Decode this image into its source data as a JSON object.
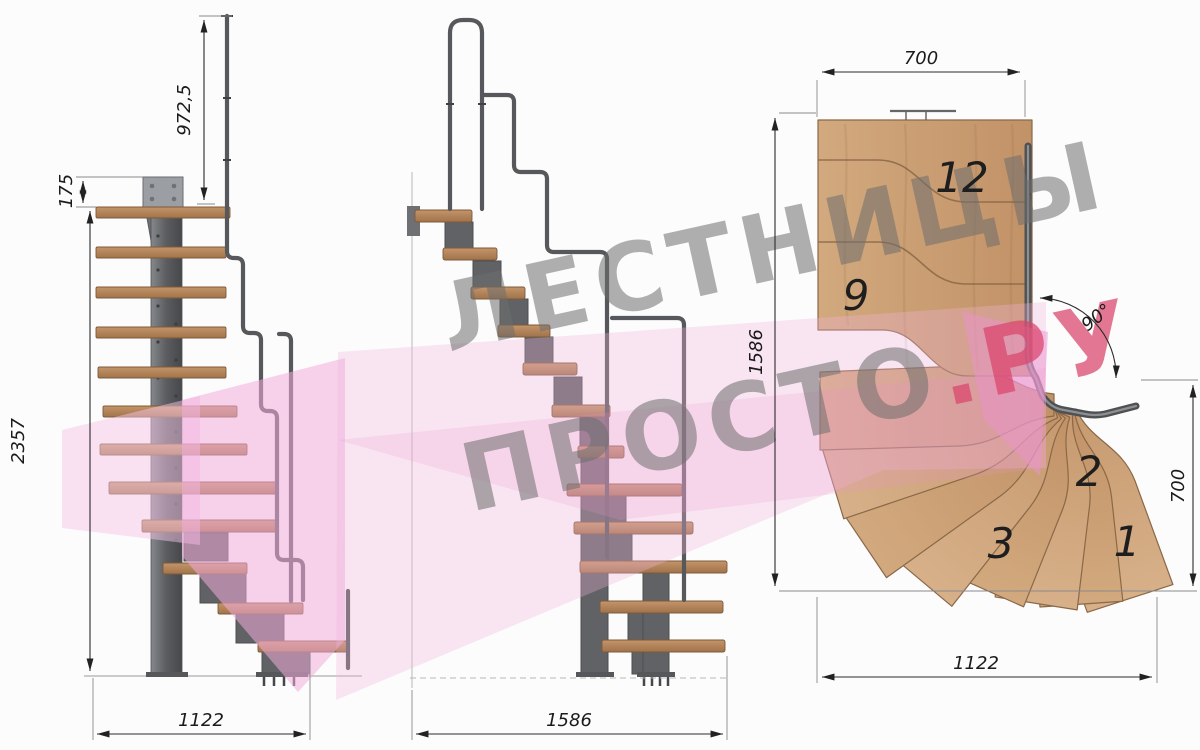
{
  "watermark": {
    "line1": "ЛЕСТНИЦЫ",
    "line2_gray": "ПРОСТО",
    "line2_pink": ".РУ"
  },
  "views": {
    "front": {
      "dims": {
        "handrail_height": "972,5",
        "bracket_offset": "175",
        "total_height": "2357",
        "width": "1122"
      }
    },
    "side": {
      "dims": {
        "depth": "1586"
      }
    },
    "plan": {
      "dims": {
        "top_width": "700",
        "left_depth": "1586",
        "right_depth": "700",
        "bottom_width": "1122",
        "turn_angle": "90°"
      },
      "steps": {
        "s12": "12",
        "s9": "9",
        "s3": "3",
        "s2": "2",
        "s1": "1"
      }
    }
  },
  "colors": {
    "background": "#fcfcfc",
    "wood_front": "#b98a5e",
    "wood_plan": "#cda47a",
    "metal": "#5d5f62",
    "dim_line": "#2b2b2b",
    "watermark_gray": "#6e6e6e",
    "watermark_pink": "#d9446b",
    "watermark_arrow": "#f2b3de"
  }
}
